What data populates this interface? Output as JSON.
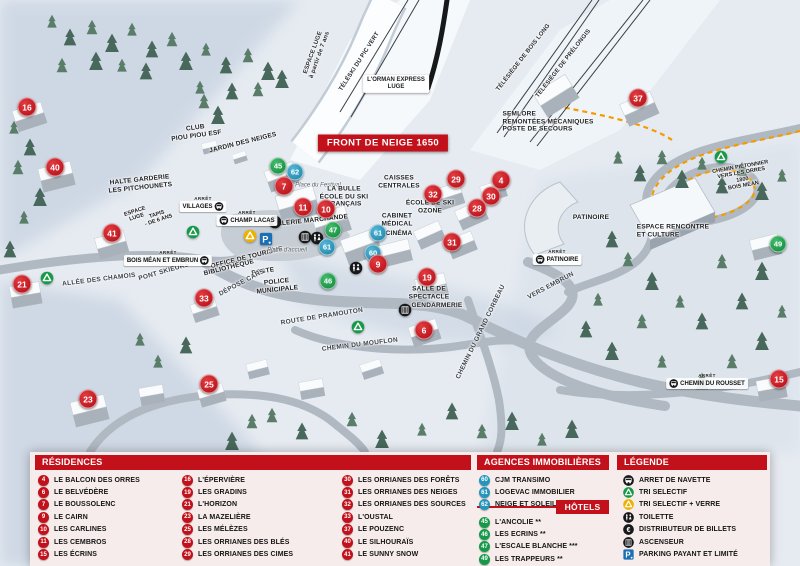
{
  "title_banner": "FRONT DE NEIGE 1650",
  "arret_prefix": "ARRÊT",
  "colors": {
    "res": "#c3111b",
    "agency": "#2596bb",
    "hotel": "#169a49",
    "header": "#c3111b",
    "path": "#f59b00"
  },
  "map": {
    "markers": [
      {
        "n": "16",
        "t": "res",
        "x": 27,
        "y": 107
      },
      {
        "n": "40",
        "t": "res",
        "x": 55,
        "y": 167
      },
      {
        "n": "41",
        "t": "res",
        "x": 112,
        "y": 233
      },
      {
        "n": "21",
        "t": "res",
        "x": 22,
        "y": 284
      },
      {
        "n": "33",
        "t": "res",
        "x": 204,
        "y": 298
      },
      {
        "n": "23",
        "t": "res",
        "x": 88,
        "y": 399
      },
      {
        "n": "25",
        "t": "res",
        "x": 209,
        "y": 384
      },
      {
        "n": "45",
        "t": "hotel",
        "x": 278,
        "y": 166
      },
      {
        "n": "62",
        "t": "agency",
        "x": 295,
        "y": 172
      },
      {
        "n": "7",
        "t": "res",
        "x": 284,
        "y": 186
      },
      {
        "n": "11",
        "t": "res",
        "x": 303,
        "y": 207
      },
      {
        "n": "10",
        "t": "res",
        "x": 326,
        "y": 209
      },
      {
        "n": "47",
        "t": "hotel",
        "x": 333,
        "y": 230
      },
      {
        "n": "61",
        "t": "agency",
        "x": 327,
        "y": 247
      },
      {
        "n": "46",
        "t": "hotel",
        "x": 328,
        "y": 281
      },
      {
        "n": "61",
        "t": "agency",
        "x": 378,
        "y": 233
      },
      {
        "n": "60",
        "t": "agency",
        "x": 373,
        "y": 253
      },
      {
        "n": "9",
        "t": "res",
        "x": 378,
        "y": 264
      },
      {
        "n": "19",
        "t": "res",
        "x": 427,
        "y": 277
      },
      {
        "n": "6",
        "t": "res",
        "x": 424,
        "y": 330
      },
      {
        "n": "29",
        "t": "res",
        "x": 456,
        "y": 179
      },
      {
        "n": "4",
        "t": "res",
        "x": 501,
        "y": 180
      },
      {
        "n": "32",
        "t": "res",
        "x": 433,
        "y": 194
      },
      {
        "n": "30",
        "t": "res",
        "x": 491,
        "y": 196
      },
      {
        "n": "28",
        "t": "res",
        "x": 477,
        "y": 208
      },
      {
        "n": "31",
        "t": "res",
        "x": 452,
        "y": 242
      },
      {
        "n": "37",
        "t": "res",
        "x": 638,
        "y": 98
      },
      {
        "n": "49",
        "t": "hotel",
        "x": 778,
        "y": 244
      },
      {
        "n": "15",
        "t": "res",
        "x": 779,
        "y": 379
      }
    ],
    "stops": [
      {
        "name": "VILLAGES",
        "x": 203,
        "y": 204,
        "icon": "right"
      },
      {
        "name": "CHAMP LACAS",
        "x": 247,
        "y": 218,
        "icon": "left"
      },
      {
        "name": "BOIS MÉAN ET EMBRUN",
        "x": 168,
        "y": 258,
        "icon": "right"
      },
      {
        "name": "PATINOIRE",
        "x": 557,
        "y": 257,
        "icon": "left"
      },
      {
        "name": "CHEMIN DU ROUSSET",
        "x": 707,
        "y": 381,
        "icon": "left"
      }
    ],
    "icons": [
      {
        "k": "tri",
        "x": 193,
        "y": 232
      },
      {
        "k": "tri",
        "x": 47,
        "y": 278
      },
      {
        "k": "tri",
        "x": 358,
        "y": 327
      },
      {
        "k": "tri",
        "x": 721,
        "y": 157
      },
      {
        "k": "tri_verre",
        "x": 250,
        "y": 236
      },
      {
        "k": "parking",
        "x": 266,
        "y": 239
      },
      {
        "k": "euro",
        "x": 275,
        "y": 222
      },
      {
        "k": "ascenseur",
        "x": 305,
        "y": 237
      },
      {
        "k": "toilette",
        "x": 317,
        "y": 238
      },
      {
        "k": "toilette",
        "x": 356,
        "y": 268
      },
      {
        "k": "ascenseur",
        "x": 405,
        "y": 310
      }
    ],
    "labels": [
      {
        "text": "TÉLÉSKI DU PIC VERT",
        "x": 360,
        "y": 62,
        "rot": -57,
        "cls": "lift"
      },
      {
        "text": "L'ORMAN EXPRESS\nLUGE",
        "x": 396,
        "y": 84,
        "rot": 0,
        "cls": "pill"
      },
      {
        "text": "TÉLÉSIÈGE DE BOIS LONG",
        "x": 524,
        "y": 58,
        "rot": -52,
        "cls": "lift"
      },
      {
        "text": "TÉLÉSIÈGE DE PRÉLONGIS",
        "x": 564,
        "y": 64,
        "rot": -52,
        "cls": "lift"
      },
      {
        "text": "SEMLORE\nREMONTÉES MÉCANIQUES\nPOSTE DE SECOURS",
        "x": 548,
        "y": 122,
        "rot": 0,
        "cls": "poi poi-left"
      },
      {
        "text": "CHEMIN PIÉTONNIER\nVERS LES ORRES 1800\nBOIS MÉAN",
        "x": 742,
        "y": 177,
        "rot": -10,
        "cls": "tiny"
      },
      {
        "text": "ESPACE LUGE\nà partir de 7 ans",
        "x": 317,
        "y": 54,
        "rot": -70,
        "cls": "lift"
      },
      {
        "text": "CLUB\nPIOU PIOU ESF",
        "x": 196,
        "y": 132,
        "rot": -8,
        "cls": "poi"
      },
      {
        "text": "JARDIN DES NEIGES",
        "x": 243,
        "y": 143,
        "rot": -14,
        "cls": "poi"
      },
      {
        "text": "HALTE GARDERIE\nLES PITCHOUNETS",
        "x": 140,
        "y": 184,
        "rot": -6,
        "cls": "poi"
      },
      {
        "text": "ESPACE\nLUGE",
        "x": 136,
        "y": 215,
        "rot": -18,
        "cls": "tiny"
      },
      {
        "text": "TAPIS\n- DE 6 ANS",
        "x": 158,
        "y": 218,
        "rot": -18,
        "cls": "tiny"
      },
      {
        "text": "ALLÉE DES CHAMOIS",
        "x": 99,
        "y": 280,
        "rot": -7,
        "cls": "road"
      },
      {
        "text": "PONT SKIEURS",
        "x": 164,
        "y": 272,
        "rot": -16,
        "cls": "road"
      },
      {
        "text": "Place du Festival",
        "x": 318,
        "y": 186,
        "rot": 0,
        "cls": "place"
      },
      {
        "text": "LA BULLE\nÉCOLE DU SKI\nFRANÇAIS",
        "x": 344,
        "y": 197,
        "rot": 0,
        "cls": "poi"
      },
      {
        "text": "GALERIE MARCHANDE",
        "x": 310,
        "y": 221,
        "rot": -6,
        "cls": "poi"
      },
      {
        "text": "CAISSES\nCENTRALES",
        "x": 399,
        "y": 182,
        "rot": 0,
        "cls": "poi"
      },
      {
        "text": "CABINET\nMÉDICAL",
        "x": 397,
        "y": 220,
        "rot": 0,
        "cls": "poi"
      },
      {
        "text": "CINÉMA",
        "x": 399,
        "y": 234,
        "rot": 0,
        "cls": "poi"
      },
      {
        "text": "ÉCOLE DE SKI\nOZONE",
        "x": 430,
        "y": 207,
        "rot": 0,
        "cls": "poi"
      },
      {
        "text": "OFFICE DE TOURISME",
        "x": 247,
        "y": 258,
        "rot": -14,
        "cls": "poi"
      },
      {
        "text": "BIBLIOTHÈQUE",
        "x": 229,
        "y": 268,
        "rot": -14,
        "cls": "poi"
      },
      {
        "text": "POSTE",
        "x": 263,
        "y": 272,
        "rot": -10,
        "cls": "poi"
      },
      {
        "text": "POLICE\nMUNICIPALE",
        "x": 277,
        "y": 286,
        "rot": -6,
        "cls": "poi"
      },
      {
        "text": "DÉPOSE CARS",
        "x": 242,
        "y": 283,
        "rot": -28,
        "cls": "road"
      },
      {
        "text": "Place d'accueil",
        "x": 287,
        "y": 251,
        "rot": 0,
        "cls": "place"
      },
      {
        "text": "ROUTE DE PRAMOUTON",
        "x": 322,
        "y": 317,
        "rot": -9,
        "cls": "road"
      },
      {
        "text": "CHEMIN DU MOUFLON",
        "x": 360,
        "y": 345,
        "rot": -7,
        "cls": "road"
      },
      {
        "text": "CHEMIN DU GRAND CORBEAU",
        "x": 481,
        "y": 332,
        "rot": -64,
        "cls": "road"
      },
      {
        "text": "SALLE DE\nSPECTACLE",
        "x": 429,
        "y": 293,
        "rot": 0,
        "cls": "poi"
      },
      {
        "text": "GENDARMERIE",
        "x": 437,
        "y": 306,
        "rot": 0,
        "cls": "poi"
      },
      {
        "text": "PATINOIRE",
        "x": 591,
        "y": 218,
        "rot": 0,
        "cls": "poi"
      },
      {
        "text": "ESPACE RENCONTRE\nET CULTURE",
        "x": 673,
        "y": 231,
        "rot": 0,
        "cls": "poi poi-left"
      },
      {
        "text": "VERS EMBRUN",
        "x": 551,
        "y": 286,
        "rot": -28,
        "cls": "road"
      }
    ]
  },
  "legend": {
    "residences": {
      "header": "RÉSIDENCES",
      "cols": [
        [
          {
            "n": "4",
            "label": "LE BALCON DES ORRES"
          },
          {
            "n": "6",
            "label": "LE BELVÉDÈRE"
          },
          {
            "n": "7",
            "label": "LE BOUSSOLENC"
          },
          {
            "n": "9",
            "label": "LE CAIRN"
          },
          {
            "n": "10",
            "label": "LES CARLINES"
          },
          {
            "n": "11",
            "label": "LES CEMBROS"
          },
          {
            "n": "15",
            "label": "LES ÉCRINS"
          }
        ],
        [
          {
            "n": "16",
            "label": "L'ÉPERVIÈRE"
          },
          {
            "n": "19",
            "label": "LES GRADINS"
          },
          {
            "n": "21",
            "label": "L'HORIZON"
          },
          {
            "n": "23",
            "label": "LA MAZELIÈRE"
          },
          {
            "n": "25",
            "label": "LES MÉLÈZES"
          },
          {
            "n": "28",
            "label": "LES ORRIANES DES BLÉS"
          },
          {
            "n": "29",
            "label": "LES ORRIANES DES CIMES"
          }
        ],
        [
          {
            "n": "30",
            "label": "LES ORRIANES DES FORÊTS"
          },
          {
            "n": "31",
            "label": "LES ORRIANES DES NEIGES"
          },
          {
            "n": "32",
            "label": "LES ORRIANES DES SOURCES"
          },
          {
            "n": "33",
            "label": "L'OUSTAL"
          },
          {
            "n": "37",
            "label": "LE POUZENC"
          },
          {
            "n": "40",
            "label": "LE SILHOURAÏS"
          },
          {
            "n": "41",
            "label": "LE SUNNY SNOW"
          }
        ]
      ]
    },
    "agences": {
      "header": "AGENCES IMMOBILIÈRES",
      "items": [
        {
          "n": "60",
          "label": "CJM TRANSIMO"
        },
        {
          "n": "61",
          "label": "LOGEVAC IMMOBILIER"
        },
        {
          "n": "62",
          "label": "NEIGE ET SOLEIL"
        }
      ]
    },
    "hotels": {
      "header": "HÔTELS",
      "items": [
        {
          "n": "45",
          "label": "L'ANCOLIE **"
        },
        {
          "n": "46",
          "label": "LES ECRINS **"
        },
        {
          "n": "47",
          "label": "L'ESCALE BLANCHE ***"
        },
        {
          "n": "49",
          "label": "LES TRAPPEURS **"
        }
      ]
    },
    "legende": {
      "header": "LÉGENDE",
      "items": [
        {
          "icon": "bus",
          "label": "ARRET DE NAVETTE"
        },
        {
          "icon": "tri",
          "label": "TRI SELECTIF"
        },
        {
          "icon": "tri_verre",
          "label": "TRI SELECTIF + VERRE"
        },
        {
          "icon": "toilette",
          "label": "TOILETTE"
        },
        {
          "icon": "euro",
          "label": "DISTRIBUTEUR DE BILLETS"
        },
        {
          "icon": "ascenseur",
          "label": "ASCENSEUR"
        },
        {
          "icon": "parking",
          "label": "PARKING PAYANT ET LIMITÉ"
        }
      ]
    }
  }
}
